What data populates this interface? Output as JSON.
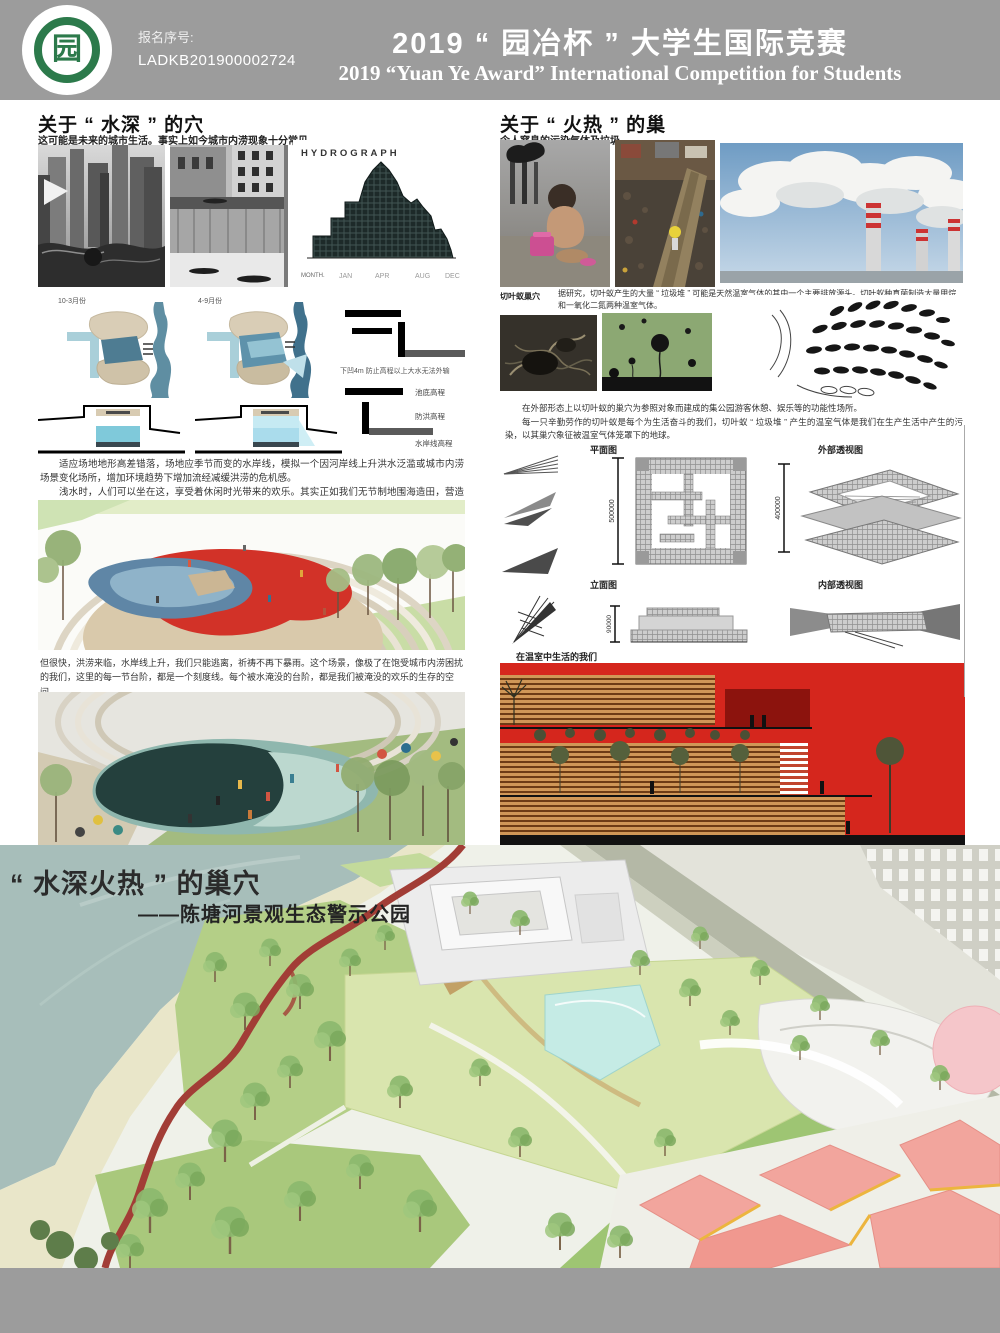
{
  "header": {
    "entry_label": "报名序号:",
    "entry_no": "LADKB201900002724",
    "title_cn": "2019 “ 园冶杯 ” 大学生国际竞赛",
    "title_en": "2019 “Yuan Ye Award” International Competition for  Students",
    "logo_glyph": "园"
  },
  "water_section": {
    "title": "关于 “ 水深 ” 的穴",
    "subtitle": "这可能是未来的城市生活。事实上如今城市内涝现象十分常见",
    "hydrograph": {
      "title": "HYDROGRAPH",
      "x_label": "MONTH.",
      "ticks": [
        "JAN",
        "APR",
        "AUG",
        "DEC"
      ]
    },
    "plan_a_label": "10-3月份",
    "plan_b_label": "4-9月份",
    "legend_note": "下凹4m 防止高程以上大水无法外输",
    "legend_items": [
      "池底高程",
      "防洪高程",
      "水岸线高程"
    ],
    "para1": "适应场地地形高差错落，场地应季节而变的水岸线，模拟一个因河岸线上升洪水泛滥或城市内涝场景变化场所，增加环境趋势下增加流经减缓洪涝的危机感。",
    "para2": "浅水时，人们可以坐在这，享受着休闲时光带来的欢乐。其实正如我们无节制地围海造田，营造人类的乐园，享受短暂的欢愉。",
    "para3": "但很快，洪涝来临，水岸线上升，我们只能逃离，祈祷不再下暴雨。这个场景，像极了在饱受城市内涝困扰的我们，这里的每一节台阶，都是一个刻度线。每个被水淹没的台阶，都是我们被淹没的欢乐的生存的空间。"
  },
  "fire_section": {
    "title": "关于 “ 火热 ” 的巢",
    "subtitle": "令人窒息的污染气体及垃圾",
    "ant_label": "切叶蚁巢穴",
    "ant_text": "据研究，切叶蚁产生的大量 “ 垃圾堆 ” 可能是天然温室气体的其中一个主要排放源头。切叶蚁种真菌制造大量甲烷和一氧化二氮两种温室气体。",
    "para1": "在外部形态上以切叶蚁的巢穴为参照对象而建成的集公园游客休憩、娱乐等的功能性场所。",
    "para2": "每一只辛勤劳作的切叶蚁是每个为生活奋斗的我们，切叶蚁 “ 垃圾堆 ” 产生的温室气体是我们在生产生活中产生的污染，以其巢穴象征被温室气体笼罩下的地球。",
    "drawings": {
      "plan_label": "平面图",
      "plan_dim": "500000",
      "exterior_label": "外部透视图",
      "exterior_dim": "400000",
      "elevation_label": "立面图",
      "elevation_dim": "90000",
      "interior_label": "内部透视图"
    },
    "greenhouse_caption": "在温室中生活的我们"
  },
  "masterplan": {
    "title": "“ 水深火热 ” 的巢穴",
    "subtitle": "——陈塘河景观生态警示公园"
  },
  "colors": {
    "header_gray": "#9c9c9c",
    "accent_red": "#d5261d",
    "water_teal": "#a7beba",
    "lawn_green": "#b4cf87",
    "pale_lawn": "#d9e5ae",
    "pink_canopy": "#f2a59d"
  }
}
